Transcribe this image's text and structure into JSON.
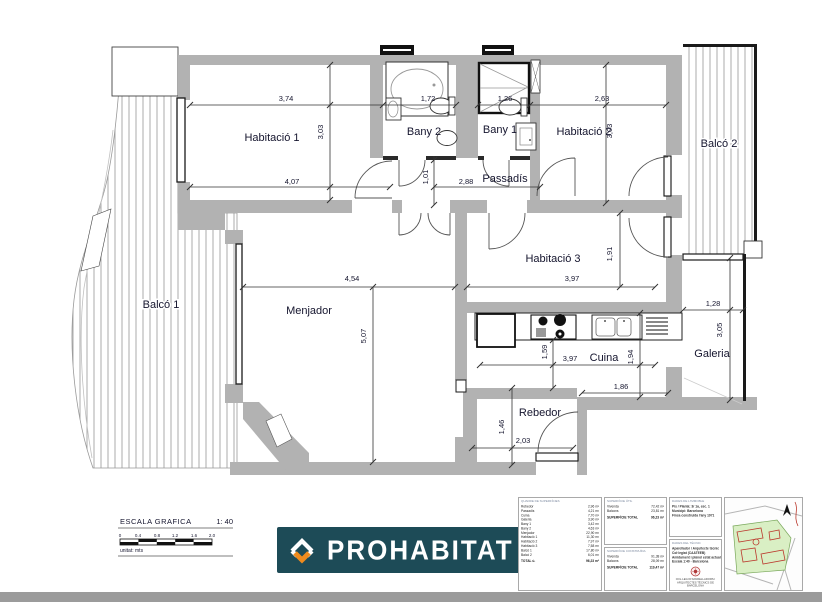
{
  "plan": {
    "rooms": {
      "hab1": "Habitació 1",
      "bany2": "Bany 2",
      "bany1": "Bany 1",
      "hab2": "Habitació 2",
      "balco2": "Balcó 2",
      "passadis": "Passadís",
      "hab3": "Habitació 3",
      "menjador": "Menjador",
      "balco1": "Balcó 1",
      "cuina": "Cuina",
      "galeria": "Galeria",
      "rebedor": "Rebedor"
    },
    "dims": {
      "hab1_top": "3,74",
      "hab1_side": "3,03",
      "hab1_bottom": "4,07",
      "bany2_w": "1,72",
      "bany1_w": "1,26",
      "hab2_top": "2,63",
      "hab2_side": "3,03",
      "pass_h": "1,01",
      "pass_w": "2,88",
      "menjador_top": "4,54",
      "menjador_side": "5,07",
      "hab3_w": "3,97",
      "hab3_side": "1,91",
      "cuina_h": "1,59",
      "cuina_w": "3,97",
      "cuina_side": "1,94",
      "cuina_bottom": "1,86",
      "galeria_w": "1,28",
      "galeria_side": "3,05",
      "rebedor_side": "1,46",
      "rebedor_w": "2,03"
    }
  },
  "scale_block": {
    "title": "ESCALA GRAFICA",
    "ratio": "1: 40",
    "ticks": [
      "0",
      "0.4",
      "0.8",
      "1.2",
      "1.6",
      "2.0"
    ],
    "unit": "unitat: mts"
  },
  "brand": {
    "name": "PROHABITAT",
    "bg_color": "#1d4b57",
    "accent_color": "#ef8b1d"
  },
  "panel": {
    "areas": {
      "title": "QUADRE DE SUPERFÍCIES",
      "rows": [
        {
          "n": "Rebedor",
          "v": "2,96 m²"
        },
        {
          "n": "Passadís",
          "v": "4,21 m²"
        },
        {
          "n": "Cuina",
          "v": "7,70 m²"
        },
        {
          "n": "Galeria",
          "v": "3,90 m²"
        },
        {
          "n": "Bany 1",
          "v": "3,42 m²"
        },
        {
          "n": "Bany 2",
          "v": "4,63 m²"
        },
        {
          "n": "Menjador",
          "v": "22,90 m²"
        },
        {
          "n": "Habitació 1",
          "v": "11,30 m²"
        },
        {
          "n": "Habitació 2",
          "v": "7,97 m²"
        },
        {
          "n": "Habitació 3",
          "v": "7,58 m²"
        },
        {
          "n": "Balcó 1",
          "v": "17,80 m²"
        },
        {
          "n": "Balcó 2",
          "v": "6,01 m²"
        }
      ],
      "total_label": "TOTAL ú.",
      "total": "96,23 m²"
    },
    "util": {
      "title": "SUPERFÍCIE ÚTIL",
      "rows": [
        {
          "n": "Vivenda",
          "v": "72,42 m²"
        },
        {
          "n": "Balcons",
          "v": "23,81 m²"
        }
      ],
      "total_label": "SUPERFÍCIE TOTAL",
      "total": "96,23 m²"
    },
    "constr": {
      "title": "SUPERFÍCIE CONSTRUÏDA",
      "rows": [
        {
          "n": "Vivenda",
          "v": "91,38 m²"
        },
        {
          "n": "Balcons",
          "v": "28,09 m²"
        }
      ],
      "total_label": "SUPERFÍCIE TOTAL",
      "total": "119,47 m²"
    },
    "immoble": {
      "title": "DADES DE L'IMMOBLE",
      "lines": [
        {
          "t": "Pis / Planta: 3r 1a, esc. 1"
        },
        {
          "t": "Municipi: Barcelona"
        },
        {
          "t": "Finca construïda l'any 1971"
        }
      ]
    },
    "tecnic": {
      "title": "DADES DEL TÈCNIC",
      "lines": [
        {
          "t": "Aparellador / Arquitecte tècnic"
        },
        {
          "t": "Col·legiat (CAATEEB)"
        },
        {
          "t": "Amidament i plànol estat actual"
        },
        {
          "t": "Escala 1:40 · Barcelona"
        }
      ],
      "stamp_caption": "COL·LEGI D'APARELLADORS I ARQUITECTES TÈCNICS DE BARCELONA"
    }
  },
  "colors": {
    "wall": "#b2b2b2",
    "line": "#222222",
    "bottom_bar": "#9b9b9b",
    "stamp_red": "#b03636",
    "map_green": "#d9efc4"
  }
}
